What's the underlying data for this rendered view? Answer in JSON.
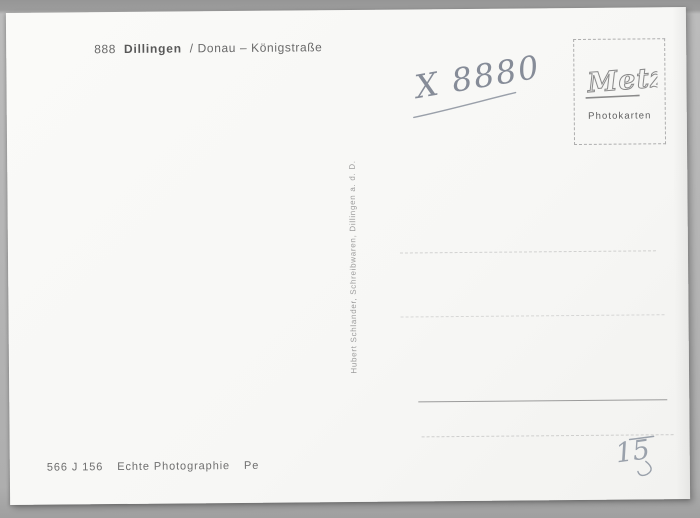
{
  "postcard": {
    "header": {
      "prefix": "888",
      "title": "Dillingen",
      "subtitle": "/ Donau – Königstraße"
    },
    "handwritten_code": "X 8880",
    "stamp_box": {
      "brand": "Metz",
      "label": "Photokarten"
    },
    "publisher_imprint": "Hubert Schlander, Schreibwaren, Dillingen a. d. D.",
    "footer": {
      "order_code": "566 J 156",
      "label": "Echte Photographie",
      "suffix": "Pe"
    },
    "handwritten_mark": "15"
  },
  "colors": {
    "scan_background": "#b0b0b0",
    "card": "#f7f7f5",
    "printed_ink": "#6a6a6a",
    "pencil": "#8b919c",
    "stamp_border": "#aeaeae"
  }
}
